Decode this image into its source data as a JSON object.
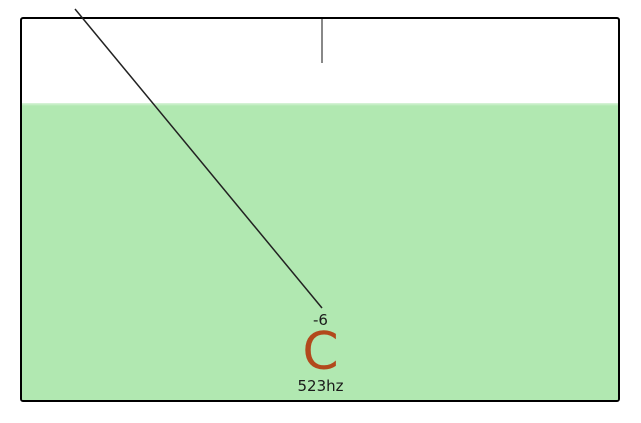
{
  "tuner": {
    "cents_offset": "-6",
    "note": "C",
    "frequency": "523hz",
    "needle": {
      "x1": 75,
      "y1": 9,
      "x2": 322,
      "y2": 308
    },
    "colors": {
      "in_tune_zone": "#b1e8b1",
      "note_text": "#b2491c",
      "needle_stroke": "#222222",
      "center_marker": "#888888",
      "frame_border": "#000000"
    }
  }
}
